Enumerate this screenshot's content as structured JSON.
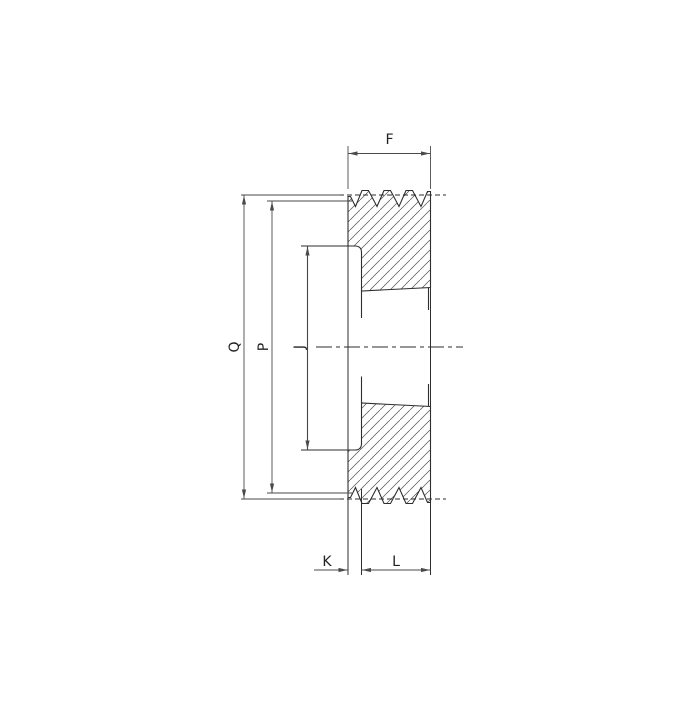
{
  "drawing": {
    "description": "Cross-section technical drawing of a grooved V-belt pulley with taper bush bore and dimension letters"
  },
  "labels": {
    "f": "F",
    "q": "Q",
    "p": "P",
    "j": "J",
    "k": "K",
    "l": "L"
  },
  "colors": {
    "object_line": "#2e2e2e",
    "dim_line": "#4a4a4a",
    "hatch": "#555555",
    "text": "#222222",
    "background": "#ffffff"
  }
}
